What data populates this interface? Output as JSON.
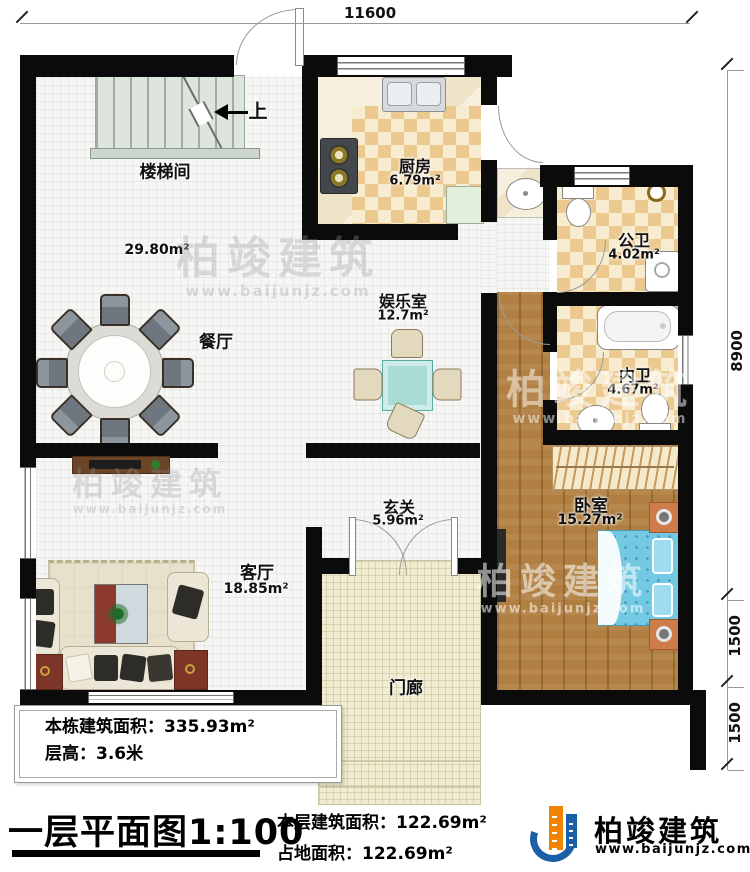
{
  "dimensions": {
    "top_width": "11600",
    "right_height": "8900",
    "right_lower1": "1500",
    "right_lower2": "1500"
  },
  "stairs": {
    "direction": "上"
  },
  "rooms": {
    "staircase": {
      "label": "楼梯间"
    },
    "open_area_size": "29.80m²",
    "dining": {
      "label": "餐厅"
    },
    "kitchen": {
      "label": "厨房",
      "area": "6.79m²"
    },
    "public_bath": {
      "label": "公卫",
      "area": "4.02m²"
    },
    "entertainment": {
      "label": "娱乐室",
      "area": "12.7m²"
    },
    "inner_bath": {
      "label": "内卫",
      "area": "4.67m²"
    },
    "foyer": {
      "label": "玄关",
      "area": "5.96m²"
    },
    "bedroom": {
      "label": "卧室",
      "area": "15.27m²"
    },
    "living": {
      "label": "客厅",
      "area": "18.85m²"
    },
    "porch": {
      "label": "门廊"
    }
  },
  "info_box": {
    "line1": "本栋建筑面积：335.93m²",
    "line2": "层高：3.6米"
  },
  "plan_title": "一层平面图1:100",
  "area_notes": {
    "line1": "本层建筑面积：122.69m²",
    "line2": "占地面积：122.69m²"
  },
  "logo": {
    "name": "柏竣建筑",
    "website": "www.baijunjz.com"
  },
  "watermark": {
    "name": "柏竣建筑",
    "website": "www.baijunjz.com"
  },
  "colors": {
    "wall": "#0b0b0b",
    "logo_blue": "#1b5fa6",
    "logo_orange": "#f08300",
    "bed": "#74c9e2",
    "wood": "#b07f41"
  }
}
